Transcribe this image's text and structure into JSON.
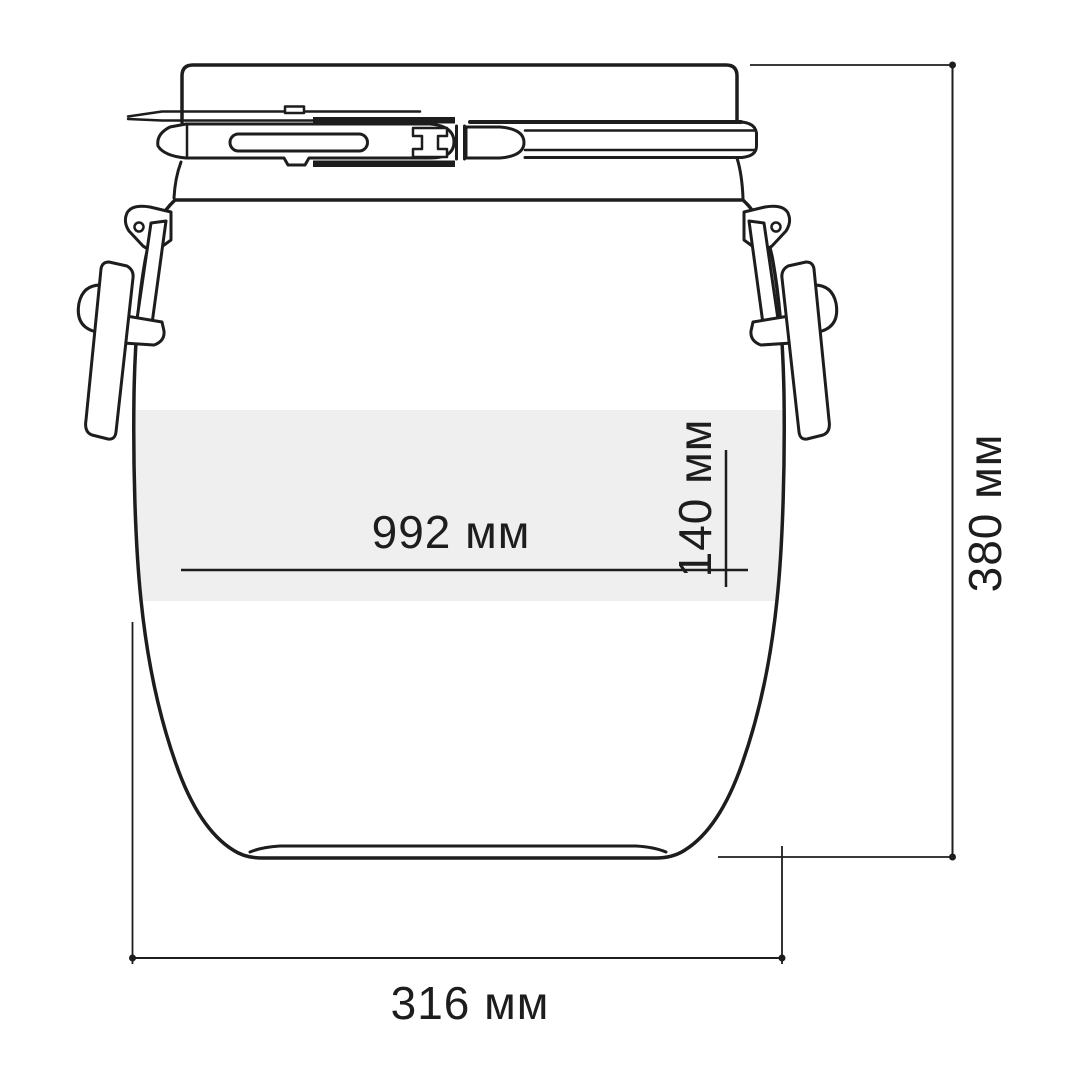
{
  "colors": {
    "line": "#1d1d1d",
    "band": "#efefef",
    "dim": "#1d1d1d",
    "text": "#1d1d1d",
    "bg": "#ffffff"
  },
  "dimensions": {
    "label_area_width": {
      "label": "992 мм",
      "value_mm": 992
    },
    "label_area_height": {
      "label": "140 мм",
      "value_mm": 140
    },
    "overall_height": {
      "label": "380 мм",
      "value_mm": 380
    },
    "bottom_width": {
      "label": "316 мм",
      "value_mm": 316
    }
  }
}
